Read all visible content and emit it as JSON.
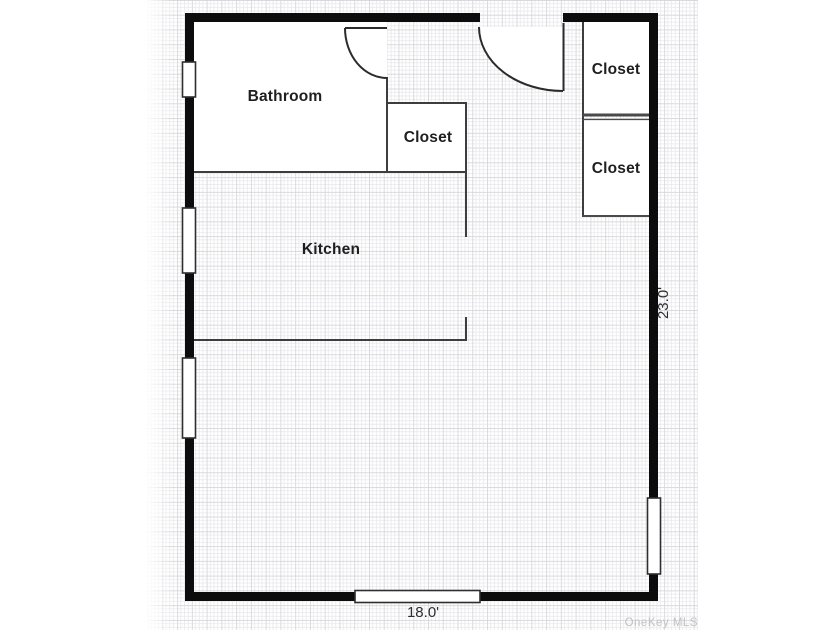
{
  "plan": {
    "rooms": {
      "bathroom": {
        "label": "Bathroom"
      },
      "bathroom_closet": {
        "label": "Closet"
      },
      "kitchen": {
        "label": "Kitchen"
      },
      "upper_right_closet": {
        "label": "Closet"
      },
      "lower_right_closet": {
        "label": "Closet"
      }
    },
    "dimensions": {
      "bottom_width": "18.0'",
      "right_height": "23.0'"
    },
    "watermark": "OneKey MLS",
    "colors": {
      "exterior_wall": "#0c0c0c",
      "interior_wall": "#3d3d3d",
      "closet_divider": "#4a4a4a",
      "window_frame": "#2e2e2e",
      "door": "#2b2b2b",
      "grid_minor": "#e8e8ec",
      "grid_major": "#d5d5d9",
      "room_label": "#1f1f1f",
      "dimension_label": "#2e2e2e",
      "watermark_gray": "#c2c2c2"
    }
  }
}
